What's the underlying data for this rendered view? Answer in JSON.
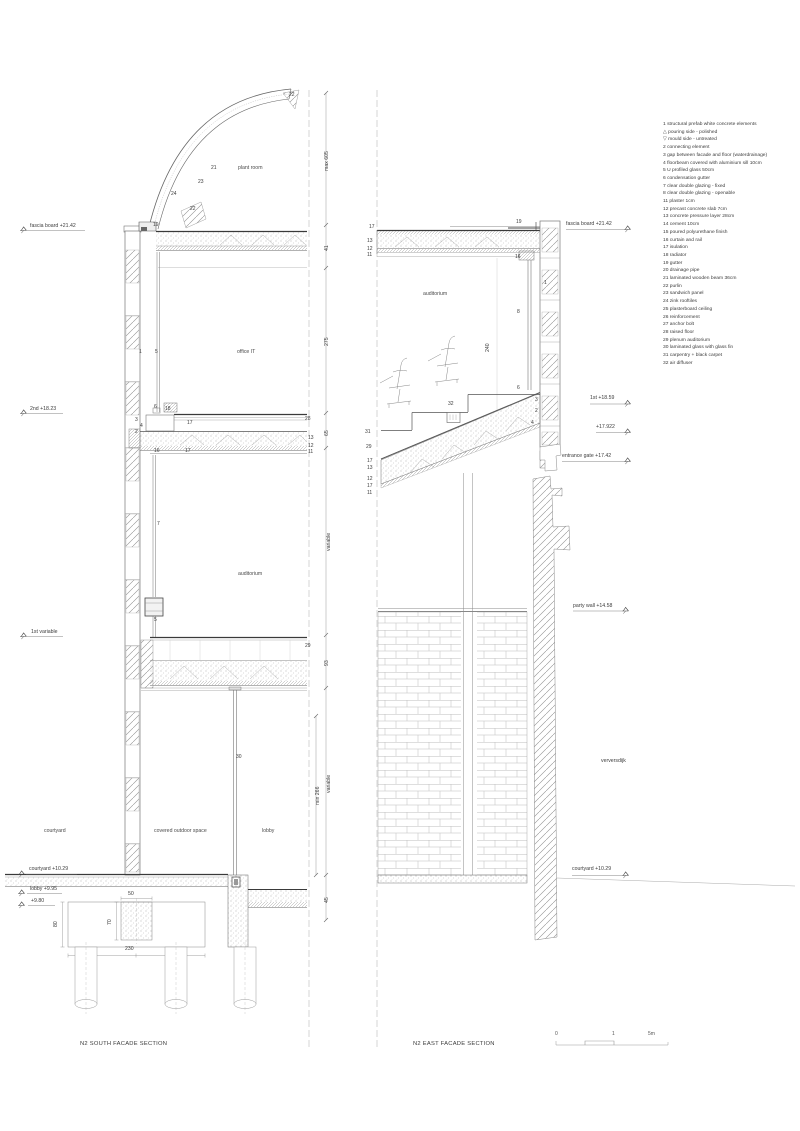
{
  "sheet": {
    "south_title": "N2 SOUTH FACADE SECTION",
    "east_title": "N2 EAST FACADE SECTION",
    "scalebar": [
      {
        "t": "0",
        "x": 555,
        "y": 1031
      },
      {
        "t": "1",
        "x": 612,
        "y": 1031
      },
      {
        "t": "5m",
        "x": 648,
        "y": 1031
      }
    ]
  },
  "legend": {
    "items": [
      "1 structural prefab white concrete elements",
      "△ pouring side - polished",
      "▽ mould side - untreated",
      "2 connecting element",
      "3 gap between facade and floor (waterdrainage)",
      "4 floorbeam covered with aluminium sill 10cm",
      "5 U profiled glass 50cm",
      "6 condensation gutter",
      "7 clear double glazing - fixed",
      "8 clear double glazing - openable",
      "11 plaster 1cm",
      "12 precast concrete slab 7cm",
      "13 concrete pressure layer 28cm",
      "14 cement 10cm",
      "15 poured polyurethane finish",
      "16 curtain and rail",
      "17 isulation",
      "18 radiator",
      "19 gutter",
      "20 drainage pipe",
      "21 laminated wooden beam 36cm",
      "22 purlin",
      "23 sandwich panel",
      "24 zink rooftiles",
      "25 plasterboard ceiling",
      "26 reinforcement",
      "27 anchor bolt",
      "28 raised floor",
      "29 plenum auditorium",
      "30 laminated glass with glass fin",
      "31 carpentry + black carpet",
      "32 air diffuser"
    ]
  },
  "south": {
    "levels": [
      {
        "t": "fascia board +21.42",
        "x": 30,
        "y": 223
      },
      {
        "t": "2nd +18.23",
        "x": 30,
        "y": 406
      },
      {
        "t": "1st variable",
        "x": 31,
        "y": 629
      },
      {
        "t": "courtyard +10.29",
        "x": 29,
        "y": 866
      },
      {
        "t": "lobby +9.95",
        "x": 30,
        "y": 886
      },
      {
        "t": "+9.80",
        "x": 31,
        "y": 898
      }
    ],
    "rooms": [
      {
        "t": "plant room",
        "x": 238,
        "y": 165
      },
      {
        "t": "office IT",
        "x": 237,
        "y": 349
      },
      {
        "t": "auditorium",
        "x": 238,
        "y": 571
      },
      {
        "t": "courtyard",
        "x": 44,
        "y": 828
      },
      {
        "t": "covered outdoor space",
        "x": 154,
        "y": 828
      },
      {
        "t": "lobby",
        "x": 262,
        "y": 828
      }
    ],
    "callouts": [
      {
        "t": "22",
        "x": 289,
        "y": 92
      },
      {
        "t": "21",
        "x": 211,
        "y": 165
      },
      {
        "t": "23",
        "x": 198,
        "y": 179
      },
      {
        "t": "24",
        "x": 171,
        "y": 191
      },
      {
        "t": "22",
        "x": 190,
        "y": 206
      },
      {
        "t": "19",
        "x": 153,
        "y": 222
      },
      {
        "t": "1",
        "x": 139,
        "y": 349
      },
      {
        "t": "5",
        "x": 155,
        "y": 349
      },
      {
        "t": "6",
        "x": 154,
        "y": 404
      },
      {
        "t": "18",
        "x": 165,
        "y": 406
      },
      {
        "t": "3",
        "x": 135,
        "y": 417
      },
      {
        "t": "4",
        "x": 140,
        "y": 423
      },
      {
        "t": "2",
        "x": 135,
        "y": 429
      },
      {
        "t": "17",
        "x": 187,
        "y": 420
      },
      {
        "t": "28",
        "x": 305,
        "y": 416
      },
      {
        "t": "16",
        "x": 154,
        "y": 448
      },
      {
        "t": "17",
        "x": 185,
        "y": 448
      },
      {
        "t": "13",
        "x": 308,
        "y": 435
      },
      {
        "t": "12",
        "x": 308,
        "y": 443
      },
      {
        "t": "11",
        "x": 308,
        "y": 449
      },
      {
        "t": "7",
        "x": 157,
        "y": 521
      },
      {
        "t": "5",
        "x": 154,
        "y": 617
      },
      {
        "t": "29",
        "x": 305,
        "y": 643
      },
      {
        "t": "30",
        "x": 236,
        "y": 754
      }
    ],
    "dims_rot": [
      {
        "t": "max 605",
        "x": 324,
        "y": 171
      },
      {
        "t": "41",
        "x": 324,
        "y": 251
      },
      {
        "t": "275",
        "x": 324,
        "y": 346
      },
      {
        "t": "65",
        "x": 324,
        "y": 436
      },
      {
        "t": "variable",
        "x": 326,
        "y": 551
      },
      {
        "t": "93",
        "x": 324,
        "y": 666
      },
      {
        "t": "variable",
        "x": 326,
        "y": 793
      },
      {
        "t": "min 266",
        "x": 315,
        "y": 805
      },
      {
        "t": "45",
        "x": 324,
        "y": 903
      },
      {
        "t": "80",
        "x": 53,
        "y": 927
      },
      {
        "t": "70",
        "x": 107,
        "y": 925
      }
    ],
    "dims_h": [
      {
        "t": "50",
        "x": 128,
        "y": 891
      },
      {
        "t": "230",
        "x": 125,
        "y": 946
      }
    ]
  },
  "east": {
    "levels": [
      {
        "t": "fascia board +21.42",
        "x": 566,
        "y": 221
      },
      {
        "t": "1st +18.59",
        "x": 590,
        "y": 395
      },
      {
        "t": "+17.922",
        "x": 596,
        "y": 424
      },
      {
        "t": "entrance gate +17.42",
        "x": 562,
        "y": 453
      },
      {
        "t": "party wall +14.58",
        "x": 573,
        "y": 603
      },
      {
        "t": "verversdijk",
        "x": 601,
        "y": 758
      },
      {
        "t": "courtyard +10.29",
        "x": 572,
        "y": 866
      }
    ],
    "rooms": [
      {
        "t": "auditorium",
        "x": 423,
        "y": 291
      }
    ],
    "callouts": [
      {
        "t": "17",
        "x": 369,
        "y": 224
      },
      {
        "t": "13",
        "x": 367,
        "y": 238
      },
      {
        "t": "12",
        "x": 367,
        "y": 246
      },
      {
        "t": "11",
        "x": 367,
        "y": 252
      },
      {
        "t": "19",
        "x": 516,
        "y": 219
      },
      {
        "t": "16",
        "x": 515,
        "y": 254
      },
      {
        "t": "1",
        "x": 544,
        "y": 280
      },
      {
        "t": "8",
        "x": 517,
        "y": 309
      },
      {
        "t": "6",
        "x": 517,
        "y": 385
      },
      {
        "t": "3",
        "x": 535,
        "y": 397
      },
      {
        "t": "2",
        "x": 535,
        "y": 408
      },
      {
        "t": "4",
        "x": 531,
        "y": 420
      },
      {
        "t": "32",
        "x": 448,
        "y": 401
      },
      {
        "t": "31",
        "x": 365,
        "y": 429
      },
      {
        "t": "29",
        "x": 366,
        "y": 444
      },
      {
        "t": "17",
        "x": 367,
        "y": 458
      },
      {
        "t": "13",
        "x": 367,
        "y": 465
      },
      {
        "t": "12",
        "x": 367,
        "y": 476
      },
      {
        "t": "17",
        "x": 367,
        "y": 483
      },
      {
        "t": "11",
        "x": 367,
        "y": 490
      }
    ],
    "dims_rot": [
      {
        "t": "240",
        "x": 485,
        "y": 352
      }
    ]
  }
}
